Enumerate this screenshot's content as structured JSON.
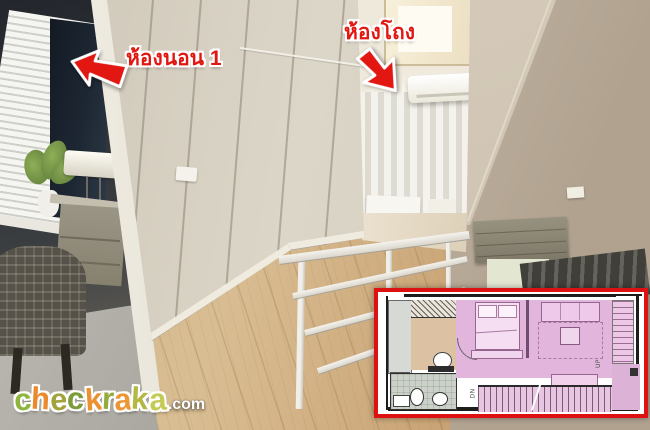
{
  "colors": {
    "accent_red": "#e31712",
    "plan_border": "#dd1111",
    "plan_room_pink": "#e2b6dc"
  },
  "annotations": {
    "bedroom": {
      "label": "ห้องนอน 1"
    },
    "hall": {
      "label": "ห้องโถง"
    }
  },
  "floorplan": {
    "dn_label": "DN",
    "up_label": "UP"
  },
  "watermark": {
    "letters": [
      {
        "ch": "c",
        "color": "#8db63c"
      },
      {
        "ch": "h",
        "color": "#ea8a2c"
      },
      {
        "ch": "e",
        "color": "#a3a33e"
      },
      {
        "ch": "c",
        "color": "#7d9c3a"
      },
      {
        "ch": "k",
        "color": "#ec9030"
      },
      {
        "ch": "r",
        "color": "#95ab3e"
      },
      {
        "ch": "a",
        "color": "#ed9636"
      },
      {
        "ch": "k",
        "color": "#b3b845"
      },
      {
        "ch": "a",
        "color": "#c3cb52"
      }
    ],
    "suffix": ".com"
  }
}
